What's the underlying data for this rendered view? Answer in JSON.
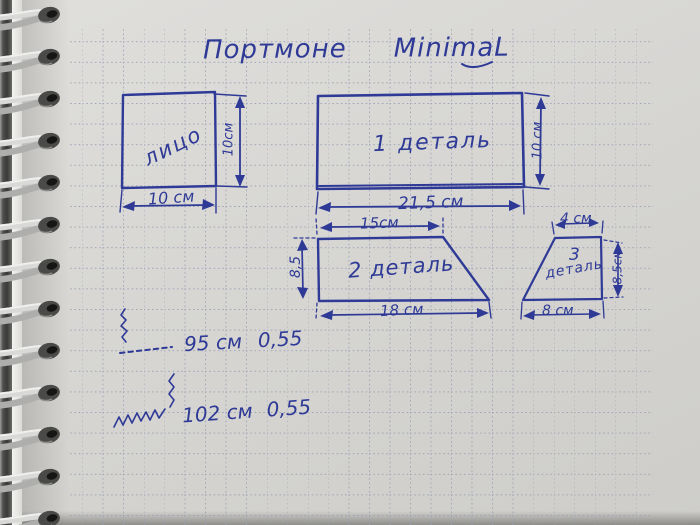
{
  "notebook": {
    "colors": {
      "ink": "#2e3a96",
      "paper": "#d7d6d3",
      "grid": "#99a0b5"
    },
    "title": {
      "word1": "Портмоне",
      "word2": "MinimaL"
    },
    "pieces": {
      "face": {
        "label": "лицо",
        "width": "10 см",
        "height": "10см"
      },
      "detail1": {
        "label": "1 деталь",
        "width": "21,5 см",
        "height": "10 см"
      },
      "detail2": {
        "label": "2 деталь",
        "top_width": "15см",
        "bottom_width": "18 см",
        "height": "8,5"
      },
      "detail3": {
        "number": "3",
        "word": "деталь",
        "top_width": "4 см",
        "bottom_width": "8 см",
        "height": "8,5см"
      }
    },
    "seams": [
      {
        "length": "95 см",
        "allowance": "0,55"
      },
      {
        "length": "102 см",
        "allowance": "0,55"
      }
    ]
  }
}
